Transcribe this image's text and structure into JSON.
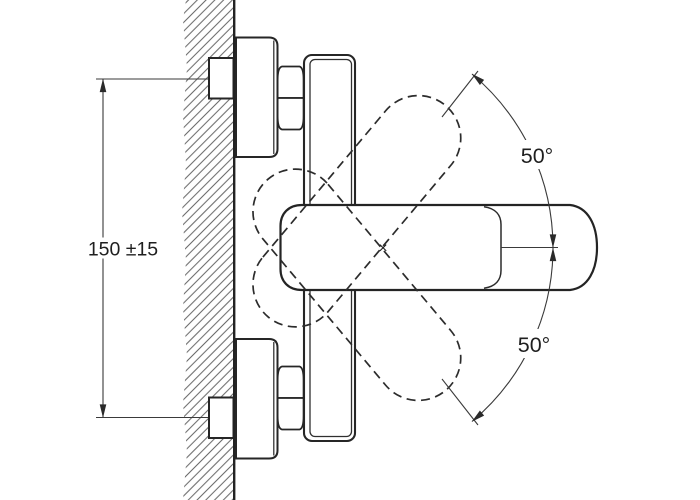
{
  "diagram": {
    "type": "technical installation drawing",
    "subject": "wall-mounted single-lever mixer tap, side view with lever swing range",
    "labels": {
      "vertical_dimension": "150 ±15",
      "angle_top": "50°",
      "angle_bottom": "50°",
      "pivot_mark": "×"
    },
    "colors": {
      "background": "#ffffff",
      "object_line": "#262626",
      "thin_line": "#3a3a3a",
      "hatch_line": "#474747"
    }
  }
}
